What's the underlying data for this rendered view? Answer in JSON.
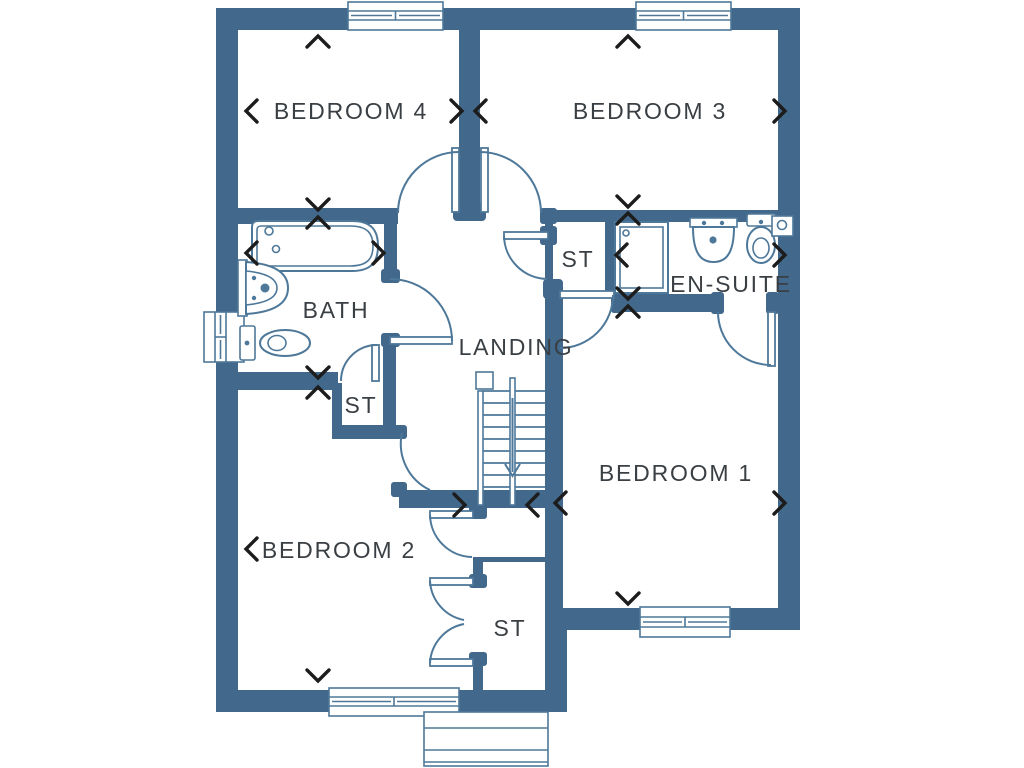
{
  "plan": {
    "type": "floor-plan",
    "rooms": {
      "bedroom4": {
        "label": "BEDROOM 4"
      },
      "bedroom3": {
        "label": "BEDROOM 3"
      },
      "bath": {
        "label": "BATH"
      },
      "storage_bath": {
        "label": "ST"
      },
      "landing": {
        "label": "LANDING"
      },
      "storage_landing": {
        "label": "ST"
      },
      "ensuite": {
        "label": "EN-SUITE"
      },
      "bedroom1": {
        "label": "BEDROOM 1"
      },
      "bedroom2": {
        "label": "BEDROOM 2"
      },
      "storage_hall": {
        "label": "ST"
      }
    },
    "colors": {
      "wall": "#42688b",
      "line": "#4e7899",
      "label": "#3a3f44",
      "dimension": "#1c1c1c",
      "background": "#ffffff"
    }
  }
}
